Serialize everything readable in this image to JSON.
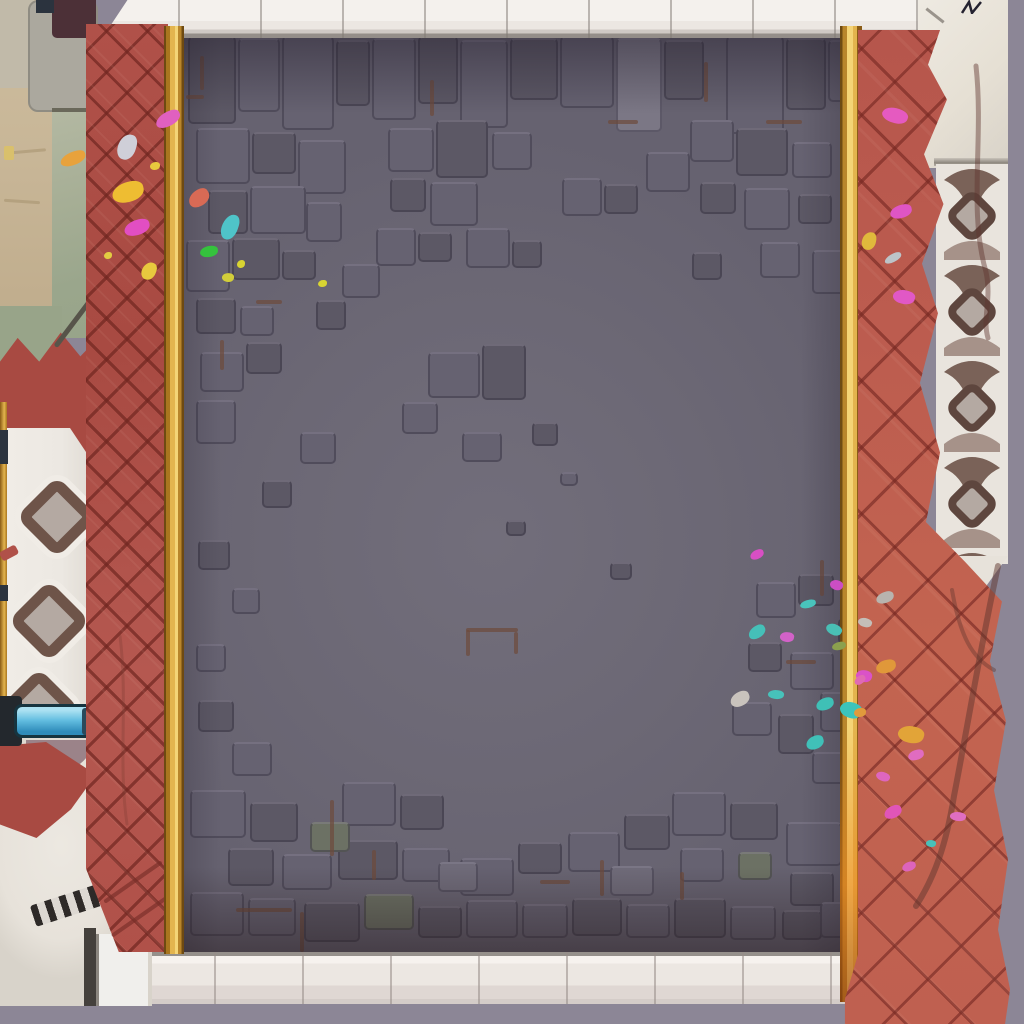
{
  "meta": {
    "title": "Top-down game arena: gray cobblestone battle floor flanked by red herringbone brick paths, gold trims, white tiled curbs, ornamental terraces and scattered confetti"
  },
  "palette": {
    "void": "#8c8696",
    "floorBase": "#6c6875",
    "floorLight": "#726e7b",
    "floorEdge": "#666270",
    "stoneL": "#7b7785",
    "stoneM": "#6f6b79",
    "stoneD": "#666271",
    "stoneK": "#5c5865",
    "stoneB": "#6f5c50",
    "stoneG": "#6c7164",
    "seamBrown": "#6d4a3a",
    "brick": "#b05149",
    "brickDeep": "#a84a42",
    "brickBright": "#c36450",
    "gold": "#e3b44e",
    "goldLight": "#f4d476",
    "goldMid": "#b8852b",
    "goldDark": "#6e4a12",
    "curb": "#ece7e2",
    "curbBright": "#f4f1ed",
    "curbShade": "#cfc9c4",
    "curbLine": "#948e89",
    "plaster": "#e7e2da",
    "tan": "#c8b697",
    "lightStone": "#c1baa9",
    "graySlab": "#aba89e",
    "maroon": "#4c3037",
    "darkMark": "#2b333e",
    "green": "#a6ae95",
    "greenDeep": "#98a489",
    "balustrade": "#ece8e2",
    "ornBrown": "#6e5449",
    "ornFill": "#b4a9a2",
    "ornDark": "#5e463e",
    "mauve": "#9b8389",
    "pipeLight": "#abe1f2",
    "pipeMid": "#62bde0",
    "pipeDeep": "#2f8cba",
    "pipeOutline": "#16343f",
    "hatchDark": "#2e2a28",
    "hatchLight": "#ddd8d2",
    "branch": "#5f352e",
    "stairDark": "#44403c",
    "stepWhite": "#f0efec"
  },
  "floor": {
    "origin": [
      166,
      30
    ],
    "stones": [
      [
        188,
        36,
        48,
        88,
        "k"
      ],
      [
        238,
        38,
        42,
        74,
        "d"
      ],
      [
        282,
        36,
        52,
        94,
        "d"
      ],
      [
        336,
        40,
        34,
        66,
        "k"
      ],
      [
        372,
        38,
        44,
        82,
        "d"
      ],
      [
        418,
        36,
        40,
        68,
        "k"
      ],
      [
        460,
        40,
        48,
        88,
        "d"
      ],
      [
        510,
        38,
        48,
        62,
        "k"
      ],
      [
        560,
        36,
        54,
        72,
        "d"
      ],
      [
        616,
        38,
        46,
        94,
        "l"
      ],
      [
        664,
        40,
        40,
        60,
        "k"
      ],
      [
        726,
        36,
        58,
        98,
        "d"
      ],
      [
        786,
        38,
        40,
        72,
        "k"
      ],
      [
        828,
        40,
        26,
        62,
        "d"
      ],
      [
        196,
        128,
        54,
        56,
        "d"
      ],
      [
        252,
        132,
        44,
        42,
        "k"
      ],
      [
        298,
        140,
        48,
        54,
        "d"
      ],
      [
        208,
        190,
        40,
        44,
        "k"
      ],
      [
        250,
        186,
        56,
        48,
        "d"
      ],
      [
        186,
        240,
        44,
        52,
        "d"
      ],
      [
        232,
        238,
        48,
        42,
        "k"
      ],
      [
        306,
        202,
        36,
        40,
        "d"
      ],
      [
        282,
        250,
        34,
        30,
        "k"
      ],
      [
        196,
        298,
        40,
        36,
        "k"
      ],
      [
        240,
        306,
        34,
        30,
        "d"
      ],
      [
        316,
        300,
        30,
        30,
        "k"
      ],
      [
        388,
        128,
        46,
        44,
        "d"
      ],
      [
        436,
        120,
        52,
        58,
        "k"
      ],
      [
        492,
        132,
        40,
        38,
        "d"
      ],
      [
        390,
        178,
        36,
        34,
        "k"
      ],
      [
        430,
        182,
        48,
        44,
        "d"
      ],
      [
        376,
        228,
        40,
        38,
        "d"
      ],
      [
        418,
        232,
        34,
        30,
        "k"
      ],
      [
        466,
        228,
        44,
        40,
        "d"
      ],
      [
        512,
        240,
        30,
        28,
        "k"
      ],
      [
        342,
        264,
        38,
        34,
        "d"
      ],
      [
        562,
        178,
        40,
        38,
        "d"
      ],
      [
        604,
        184,
        34,
        30,
        "k"
      ],
      [
        646,
        152,
        44,
        40,
        "d"
      ],
      [
        690,
        120,
        44,
        42,
        "d"
      ],
      [
        736,
        128,
        52,
        48,
        "k"
      ],
      [
        792,
        142,
        40,
        36,
        "d"
      ],
      [
        700,
        182,
        36,
        32,
        "k"
      ],
      [
        744,
        188,
        46,
        42,
        "d"
      ],
      [
        798,
        194,
        34,
        30,
        "k"
      ],
      [
        760,
        242,
        40,
        36,
        "d"
      ],
      [
        692,
        252,
        30,
        28,
        "k"
      ],
      [
        812,
        250,
        36,
        44,
        "d"
      ],
      [
        200,
        352,
        44,
        40,
        "d"
      ],
      [
        246,
        342,
        36,
        32,
        "k"
      ],
      [
        196,
        400,
        40,
        44,
        "d"
      ],
      [
        300,
        432,
        36,
        32,
        "d"
      ],
      [
        262,
        480,
        30,
        28,
        "k"
      ],
      [
        198,
        540,
        32,
        30,
        "k"
      ],
      [
        232,
        588,
        28,
        26,
        "d"
      ],
      [
        196,
        644,
        30,
        28,
        "d"
      ],
      [
        198,
        700,
        36,
        32,
        "k"
      ],
      [
        232,
        742,
        40,
        34,
        "d"
      ],
      [
        428,
        352,
        52,
        46,
        "d"
      ],
      [
        482,
        344,
        44,
        56,
        "k"
      ],
      [
        402,
        402,
        36,
        32,
        "d"
      ],
      [
        462,
        432,
        40,
        30,
        "d"
      ],
      [
        532,
        422,
        26,
        24,
        "k"
      ],
      [
        506,
        520,
        20,
        16,
        "k"
      ],
      [
        560,
        472,
        18,
        14,
        "d"
      ],
      [
        610,
        562,
        22,
        18,
        "k"
      ],
      [
        756,
        582,
        40,
        36,
        "d"
      ],
      [
        798,
        574,
        36,
        32,
        "k"
      ],
      [
        748,
        642,
        34,
        30,
        "k"
      ],
      [
        790,
        652,
        44,
        38,
        "d"
      ],
      [
        732,
        702,
        40,
        34,
        "d"
      ],
      [
        778,
        714,
        36,
        40,
        "k"
      ],
      [
        820,
        692,
        28,
        40,
        "d"
      ],
      [
        812,
        752,
        38,
        32,
        "d"
      ],
      [
        838,
        618,
        16,
        26,
        "k"
      ],
      [
        190,
        790,
        56,
        48,
        "d"
      ],
      [
        250,
        802,
        48,
        40,
        "k"
      ],
      [
        342,
        782,
        54,
        44,
        "d"
      ],
      [
        400,
        794,
        44,
        36,
        "k"
      ],
      [
        338,
        840,
        60,
        40,
        "k"
      ],
      [
        402,
        848,
        48,
        34,
        "d"
      ],
      [
        460,
        858,
        54,
        38,
        "d"
      ],
      [
        518,
        842,
        44,
        32,
        "k"
      ],
      [
        568,
        832,
        52,
        40,
        "d"
      ],
      [
        624,
        814,
        46,
        36,
        "k"
      ],
      [
        672,
        792,
        54,
        44,
        "d"
      ],
      [
        730,
        802,
        48,
        38,
        "k"
      ],
      [
        680,
        848,
        44,
        34,
        "d"
      ],
      [
        738,
        852,
        34,
        28,
        "g"
      ],
      [
        786,
        822,
        56,
        44,
        "d"
      ],
      [
        790,
        872,
        44,
        34,
        "k"
      ],
      [
        282,
        854,
        50,
        36,
        "d"
      ],
      [
        228,
        848,
        46,
        38,
        "k"
      ],
      [
        310,
        822,
        40,
        30,
        "g"
      ],
      [
        190,
        892,
        54,
        44,
        "d"
      ],
      [
        248,
        898,
        48,
        38,
        "d"
      ],
      [
        304,
        902,
        56,
        40,
        "k"
      ],
      [
        364,
        894,
        50,
        36,
        "g"
      ],
      [
        418,
        906,
        44,
        32,
        "k"
      ],
      [
        466,
        900,
        52,
        38,
        "d"
      ],
      [
        522,
        904,
        46,
        34,
        "d"
      ],
      [
        572,
        898,
        50,
        38,
        "k"
      ],
      [
        626,
        904,
        44,
        34,
        "d"
      ],
      [
        674,
        898,
        52,
        40,
        "k"
      ],
      [
        730,
        906,
        46,
        34,
        "d"
      ],
      [
        782,
        910,
        40,
        30,
        "k"
      ],
      [
        820,
        902,
        30,
        36,
        "d"
      ],
      [
        438,
        862,
        40,
        30,
        "m"
      ],
      [
        610,
        866,
        44,
        30,
        "m"
      ]
    ],
    "seams": [
      [
        466,
        628,
        52,
        4
      ],
      [
        466,
        630,
        4,
        26
      ],
      [
        514,
        632,
        4,
        22
      ],
      [
        330,
        800,
        4,
        56
      ],
      [
        300,
        912,
        4,
        40
      ],
      [
        236,
        908,
        56,
        4
      ],
      [
        186,
        95,
        18,
        4
      ],
      [
        200,
        56,
        4,
        34
      ],
      [
        704,
        62,
        4,
        40
      ],
      [
        766,
        120,
        36,
        4
      ],
      [
        820,
        560,
        4,
        36
      ],
      [
        786,
        660,
        30,
        4
      ],
      [
        220,
        340,
        4,
        30
      ],
      [
        256,
        300,
        26,
        4
      ],
      [
        600,
        860,
        4,
        36
      ],
      [
        540,
        880,
        30,
        4
      ],
      [
        430,
        80,
        4,
        36
      ],
      [
        608,
        120,
        30,
        4
      ],
      [
        680,
        872,
        4,
        28
      ],
      [
        372,
        850,
        4,
        30
      ]
    ]
  },
  "confetti": [
    [
      155,
      112,
      26,
      14,
      "#e060c0",
      -25
    ],
    [
      118,
      134,
      18,
      26,
      "#cfcfd8",
      15
    ],
    [
      60,
      152,
      26,
      13,
      "#e8a23c",
      -18
    ],
    [
      150,
      162,
      10,
      8,
      "#e8c93e",
      0
    ],
    [
      112,
      182,
      32,
      20,
      "#eebd32",
      -12
    ],
    [
      124,
      220,
      26,
      15,
      "#e24ec2",
      -15
    ],
    [
      104,
      252,
      8,
      7,
      "#e2cc42",
      0
    ],
    [
      142,
      262,
      14,
      18,
      "#e8c93e",
      20
    ],
    [
      188,
      190,
      22,
      16,
      "#d86a55",
      -30
    ],
    [
      222,
      214,
      16,
      26,
      "#4fc4c9",
      18
    ],
    [
      200,
      246,
      18,
      11,
      "#35c23d",
      -5
    ],
    [
      237,
      260,
      8,
      8,
      "#d8d432",
      0
    ],
    [
      222,
      273,
      12,
      9,
      "#d2ce3a",
      10
    ],
    [
      318,
      280,
      9,
      7,
      "#d8d432",
      0
    ],
    [
      750,
      550,
      14,
      9,
      "#d84fc4",
      -20
    ],
    [
      830,
      580,
      13,
      10,
      "#cb4ec4",
      25
    ],
    [
      800,
      600,
      16,
      8,
      "#49c4bc",
      -10
    ],
    [
      748,
      626,
      18,
      12,
      "#45c0b8",
      -28
    ],
    [
      780,
      632,
      14,
      10,
      "#d262c8",
      12
    ],
    [
      826,
      624,
      16,
      11,
      "#49bfb5",
      30
    ],
    [
      832,
      642,
      14,
      8,
      "#8ba04e",
      -8
    ],
    [
      856,
      670,
      16,
      12,
      "#da52c8",
      18
    ],
    [
      730,
      692,
      20,
      14,
      "#c9c3bd",
      -22
    ],
    [
      768,
      690,
      16,
      9,
      "#47c2ba",
      8
    ],
    [
      816,
      698,
      18,
      12,
      "#3fc0b6",
      -15
    ],
    [
      840,
      702,
      22,
      16,
      "#3cc4bb",
      25
    ],
    [
      854,
      708,
      12,
      9,
      "#e09a3c",
      0
    ],
    [
      806,
      736,
      18,
      13,
      "#40c0b8",
      -18
    ],
    [
      882,
      108,
      26,
      15,
      "#e55ac0",
      20
    ],
    [
      890,
      205,
      22,
      13,
      "#df55c4",
      -12
    ],
    [
      862,
      232,
      14,
      18,
      "#e0b93c",
      10
    ],
    [
      884,
      254,
      18,
      8,
      "#bcc4c8",
      -25
    ],
    [
      893,
      290,
      22,
      14,
      "#e158c6",
      15
    ],
    [
      876,
      592,
      18,
      11,
      "#b8b4ae",
      -15
    ],
    [
      858,
      618,
      14,
      9,
      "#c4beb8",
      20
    ],
    [
      876,
      660,
      20,
      13,
      "#e0983a",
      -10
    ],
    [
      854,
      676,
      12,
      8,
      "#e06ab4",
      -30
    ],
    [
      898,
      726,
      26,
      17,
      "#e2a438",
      15
    ],
    [
      908,
      750,
      16,
      10,
      "#e06cc0",
      -12
    ],
    [
      876,
      772,
      14,
      9,
      "#de66be",
      25
    ],
    [
      884,
      806,
      18,
      12,
      "#e055b8",
      -20
    ],
    [
      950,
      812,
      16,
      9,
      "#e06ec2",
      10
    ],
    [
      902,
      862,
      14,
      9,
      "#dd64bc",
      -15
    ],
    [
      926,
      840,
      10,
      7,
      "#48c0b8",
      12
    ]
  ],
  "ornaments": {
    "balustrade_diamonds": [
      [
        22,
        60
      ],
      [
        14,
        164
      ],
      [
        4,
        252
      ]
    ]
  }
}
